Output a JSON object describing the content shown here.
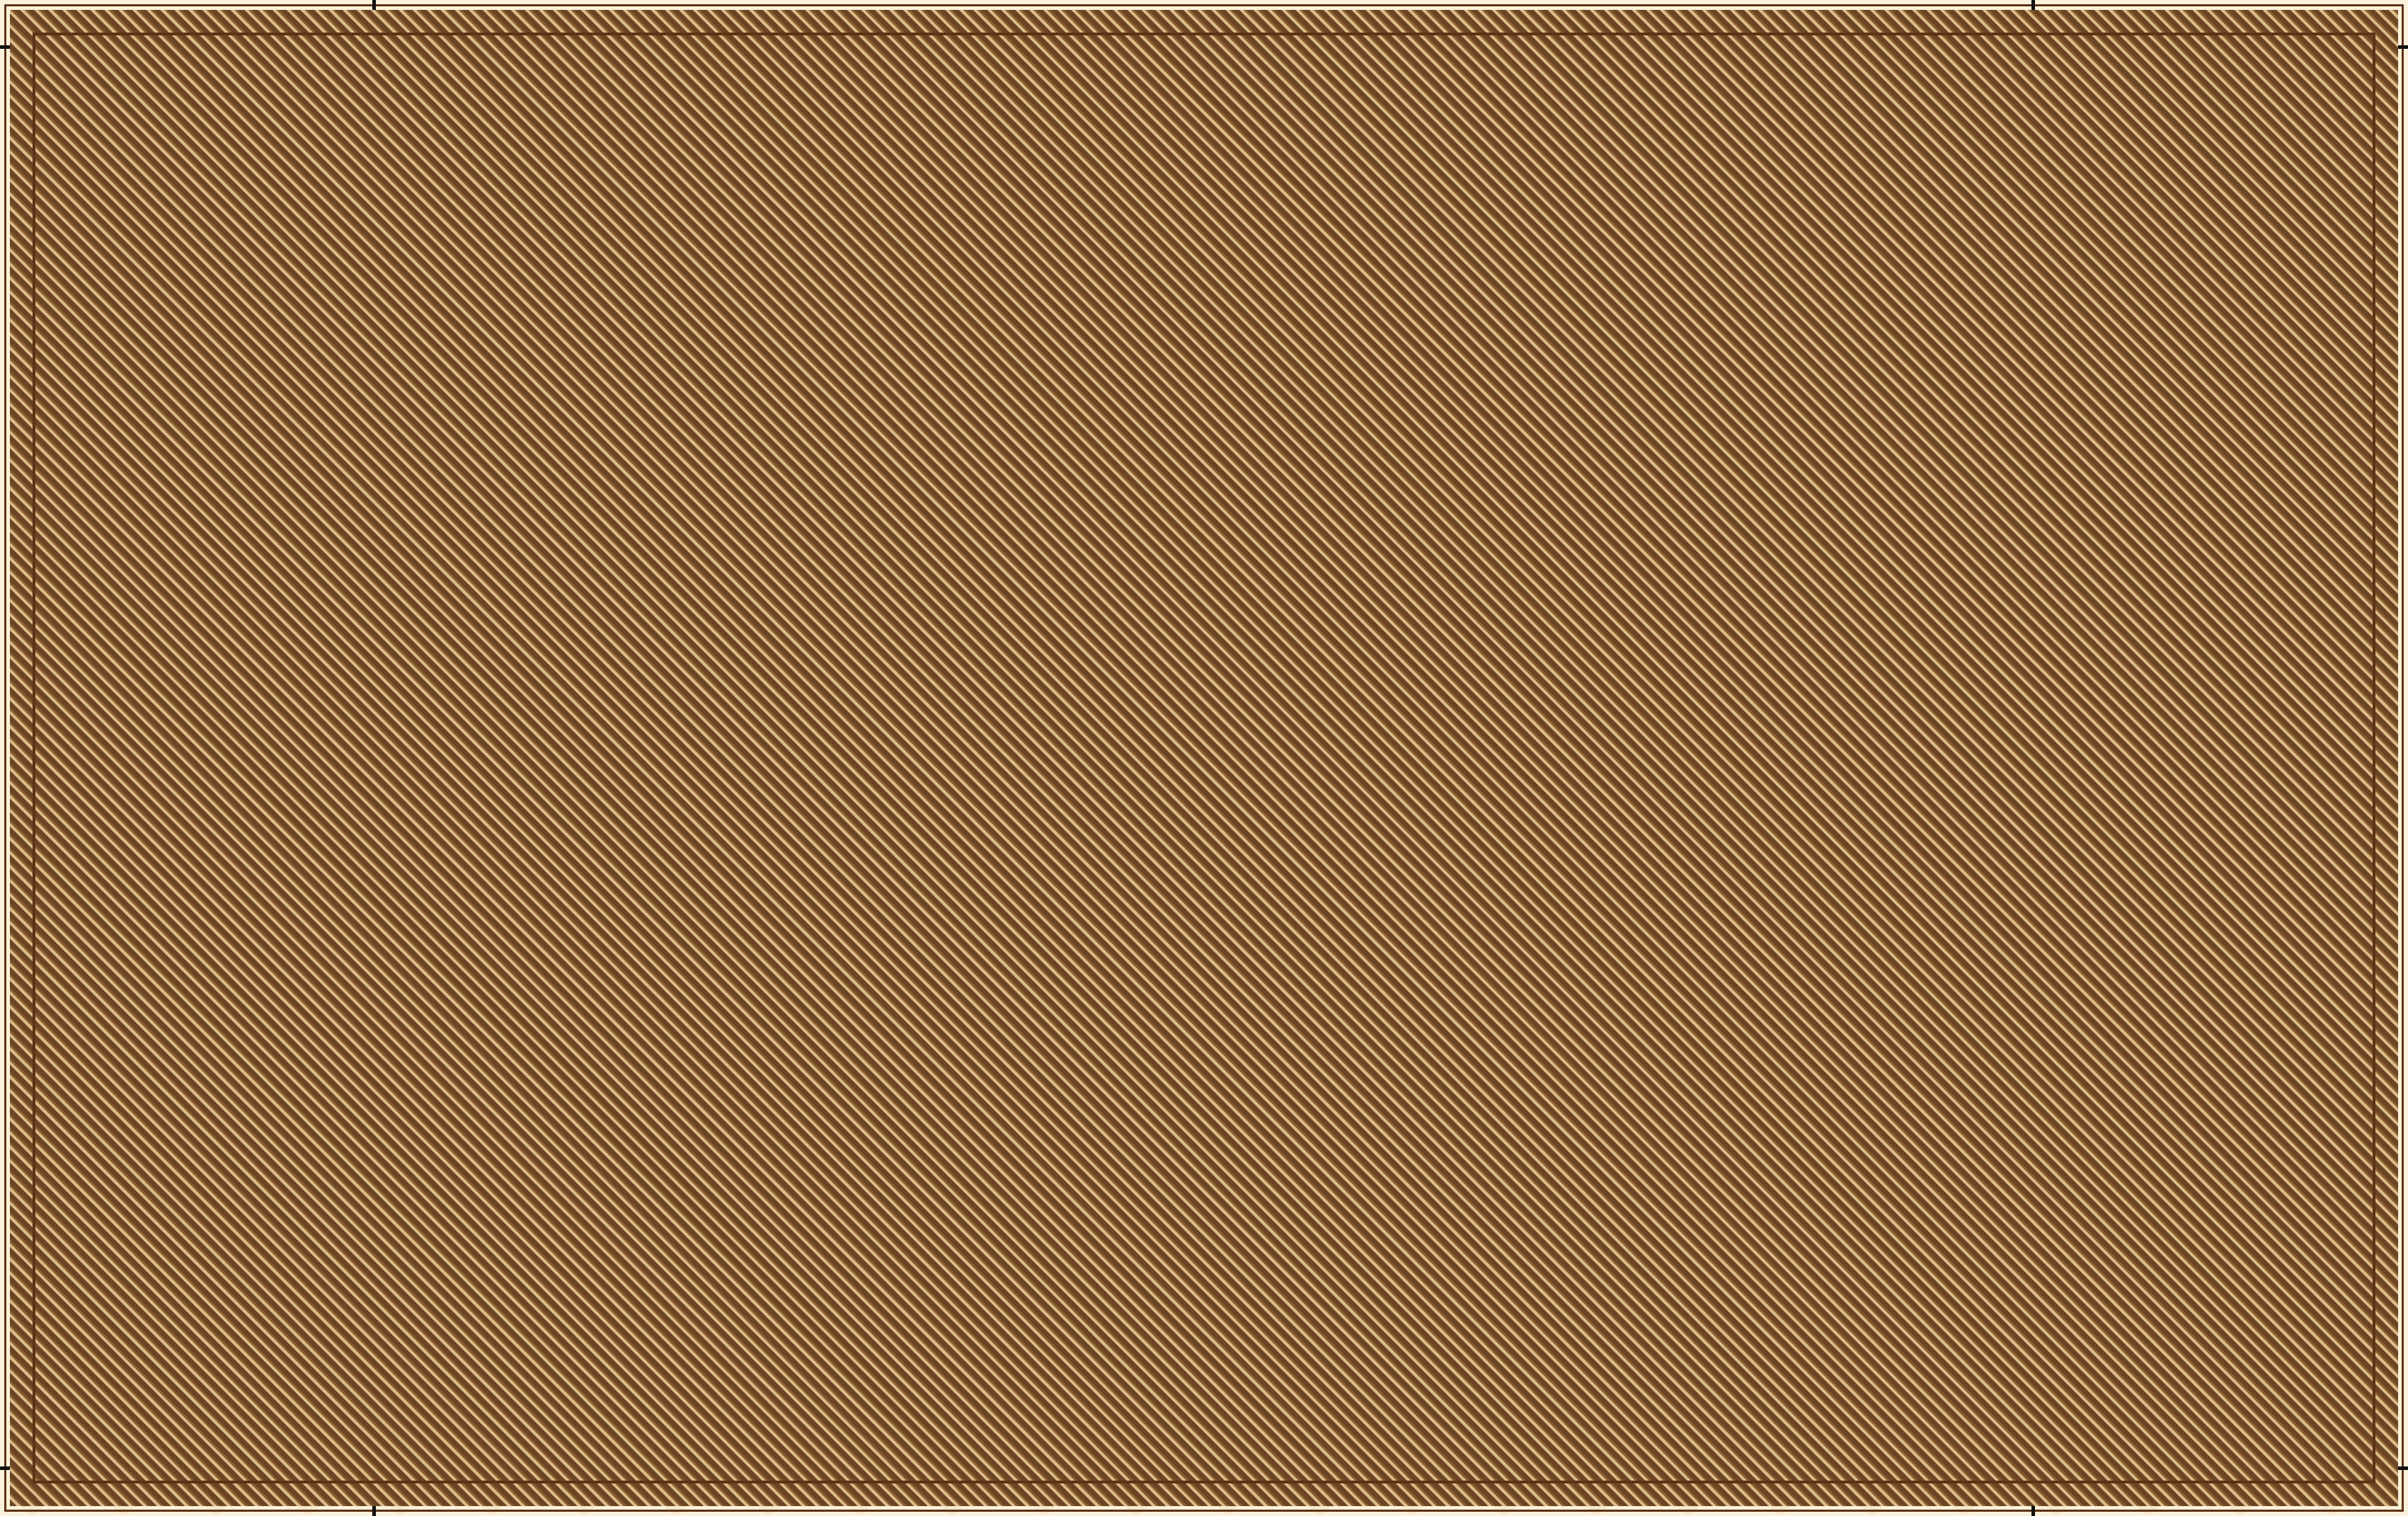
{
  "colors": {
    "paper": "#FBF1DA",
    "ink": "#5C3317",
    "red": "#C8161D",
    "orange": "#EF9310",
    "clinic_blue": "#1D6FBF",
    "water": "#2B7BC4",
    "wall_tan": "#C9A063",
    "han_road": "#57310E",
    "underground": "#F6E3B2",
    "modern_road": "#6B4423"
  },
  "header": {
    "title_cn": "漢長安城未央宮遺址",
    "title_en": "The Site of Weiyang Palace in Chang'an City of Western Handynasty",
    "map_cn": "导览图",
    "map_en": "TOURIST MAP",
    "north": "N"
  },
  "routes": {
    "heading": "参观线路\\Visiting Routes",
    "items": [
      {
        "label": "A: 西安门出入口",
        "text": "西安门出入口→前殿东侧汉代道路→前殿南侧汉代道路→未央宫前殿→前殿南侧汉代道路→章城门→西环涂路→前殿北侧汉代道路→中央官署→回形路→少府→前殿北侧汉代道路→西环涂路→丰景路→石渠阁→丰景路→天禄阁→丰景路→前殿东侧汉代道路→椒房殿→前殿东侧汉代道路→西安门出入口"
      },
      {
        "label": "B: 李西路出入口",
        "text": "李西路出入口→东宫墙路→东宫门→前殿北侧汉代道路→椒房殿→前殿东侧汉代道路→丰景路→天禄阁→丰景路→石渠阁→丰景路→西环涂路→前殿北侧汉代道路→中央官署→回形路→少府→前殿北侧汉代道路→西环涂路→章城门→前殿南侧汉代道路→未央宫前殿→前殿东侧汉代道路→西安门→南环涂路→东宫墙路→李西路出入口"
      },
      {
        "label": "C: 丰景路东出入口",
        "text": "丰景路东出入口→丰景路→天禄阁→丰景路→石渠阁→丰景路→西环涂路→前殿北侧汉代道路→中央官署→回形路→少府→前殿北侧汉代道路→西环涂路→章城门→前殿南侧汉代道路→未央宫前殿→前殿南侧汉代道路→前殿东侧汉代道路→西安门→前殿东侧汉代道路→椒房殿→前殿东侧汉代道路→丰景路→丰景路东出入口"
      },
      {
        "label": "D: 丰景路西出入口",
        "text": "丰景路西出入口→丰景路→石渠阁→丰景路→天禄阁→丰景路→前殿东侧汉代道路→椒房殿→前殿东侧汉代道路→西安门→前殿东侧汉代道路→前殿南侧汉代道路→未央宫前殿→前殿南侧汉代道路→章城门→西环涂路→前殿北侧汉代道路→中央官署→回形路→少府→前殿北侧汉代道路→西环涂路→丰景路西出入口"
      }
    ]
  },
  "facilities": {
    "heading": "设施说明\\Facilities  Illustration",
    "items": [
      {
        "icon": "info-icon",
        "cn": "信息服务",
        "en": "Tourist Centre"
      },
      {
        "icon": "phone-icon",
        "cn": "电话",
        "en": "Telephone"
      },
      {
        "icon": "clinic-icon",
        "cn": "医疗点",
        "en": "Clinic"
      },
      {
        "icon": "sightseeing-bus-icon",
        "cn": "电瓶车",
        "en": "Sightseeting Bus"
      },
      {
        "icon": "toilet-icon",
        "cn": "厕所",
        "en": "Toilet"
      },
      {
        "icon": "entrance-icon",
        "cn": "出入口",
        "en": "Entrance"
      },
      {
        "icon": "bicycle-icon",
        "cn": "自行车租赁",
        "en": "Bicycle Rental"
      },
      {
        "icon": "parking-icon",
        "cn": "停车场",
        "en": "Parking"
      },
      {
        "icon": "security-icon",
        "cn": "安全保卫",
        "en": "Security"
      },
      {
        "icon": "store-icon",
        "cn": "商店",
        "en": "Store"
      }
    ]
  },
  "legend": {
    "heading": "图例\\Map Legend",
    "items": [
      {
        "cn": "保护展示遗址",
        "en": "Protected and Displayed Ruins",
        "color": "#C8161D"
      },
      {
        "cn": "地下遗址",
        "en": "Underground Ruins",
        "color": "#F6E3B2"
      },
      {
        "cn": "城墙遗址",
        "en": "Ruins of Ancient City Wall",
        "color": "#C9A063"
      },
      {
        "cn": "汉代道路",
        "en": "Handynasty Road",
        "color": "#57310E"
      },
      {
        "cn": "现代道路",
        "en": "Modern Road",
        "color": "#8B6A3F"
      }
    ]
  },
  "map": {
    "labels": {
      "shihua": "石  化  大  道",
      "zhichengmen_street": "直城门大街",
      "zhichengmen": "直城门",
      "shiquge": "石渠阁遗址",
      "tianluge": "天禄阁遗址",
      "beigongmen": "北宫门",
      "fengjinglu": "丰 景 路",
      "fengjing_xikou": "丰景路西口",
      "fengjing_dongkou": "丰景路东口",
      "jiangshilu": "讲施路",
      "luomenlu": "洛门路",
      "dengliulu": "邓六路",
      "shaofu": "少府遗址",
      "zhongyang_1": "中央官署",
      "zhongyang_2": "遗址",
      "jiaofangdian": "椒房殿遗址",
      "mingqu": "明渠",
      "qiandian": "前殿遗址",
      "chenlieting": "汉长安城遗址陈列厅",
      "donggongmen": "东宫门",
      "xigongmen": "西宫门",
      "zhangchengmen": "章城门",
      "nangongmen": "南宫门",
      "xianmen": "西安门",
      "cangchi": "沧池（未建）",
      "xihuantulu": "西环涂路",
      "qiandian_bei": "前殿北侧汉代道路",
      "qiandian_dong": "前殿东侧汉代道路",
      "qiandian_nan": "前殿南侧汉代道路",
      "donggongqianglu": "东宫墙路",
      "jiangxilu": "讲西路",
      "lixilukou": "李西路口",
      "gelaomen": "阁 老 门",
      "nanhuantulu": "南环涂路",
      "xisanhuan": "西三环",
      "daxingxilu": "大 兴 西 路",
      "hanchengbeilu": "汉城北路",
      "erhuanbeilu": "二环北路西段",
      "zaohe": "皂河",
      "hanchenghu": "汉城湖",
      "note_nw_1": "331路、234路周河",
      "note_nw_2": "湾公交站下车即到",
      "note_s_1": "9路、217路、501路、504路、",
      "note_s_2": "901路到邓家村公交站下车延",
      "note_s_3": "大兴西路向西500米即到"
    }
  }
}
